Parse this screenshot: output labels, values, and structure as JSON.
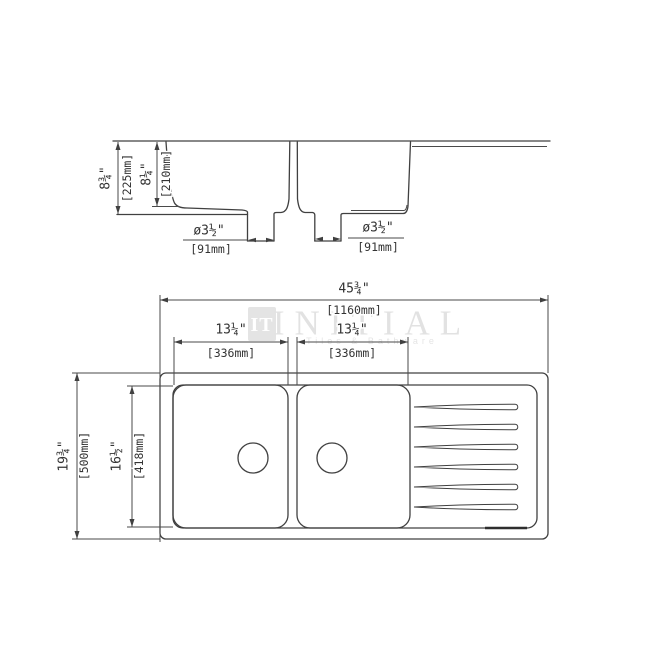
{
  "background": "#ffffff",
  "line_color": "#404040",
  "watermark": {
    "logo": "IT",
    "brand": "INITIAL",
    "tagline": "Tiles & Bathware",
    "color": "#e2e2e2"
  },
  "section_view": {
    "overall_depth_in": "8¾\"",
    "overall_depth_mm": "[225mm]",
    "bowl_depth_in": "8¼\"",
    "bowl_depth_mm": "[210mm]",
    "left_drain_in": "ø3½\"",
    "left_drain_mm": "[91mm]",
    "right_drain_in": "ø3½\"",
    "right_drain_mm": "[91mm]"
  },
  "plan_view": {
    "overall_width_in": "45¾\"",
    "overall_width_mm": "[1160mm]",
    "left_bowl_width_in": "13¼\"",
    "left_bowl_width_mm": "[336mm]",
    "right_bowl_width_in": "13¼\"",
    "right_bowl_width_mm": "[336mm]",
    "overall_depth_in": "19¾\"",
    "overall_depth_mm": "[500mm]",
    "bowl_length_in": "16½\"",
    "bowl_length_mm": "[418mm]"
  }
}
